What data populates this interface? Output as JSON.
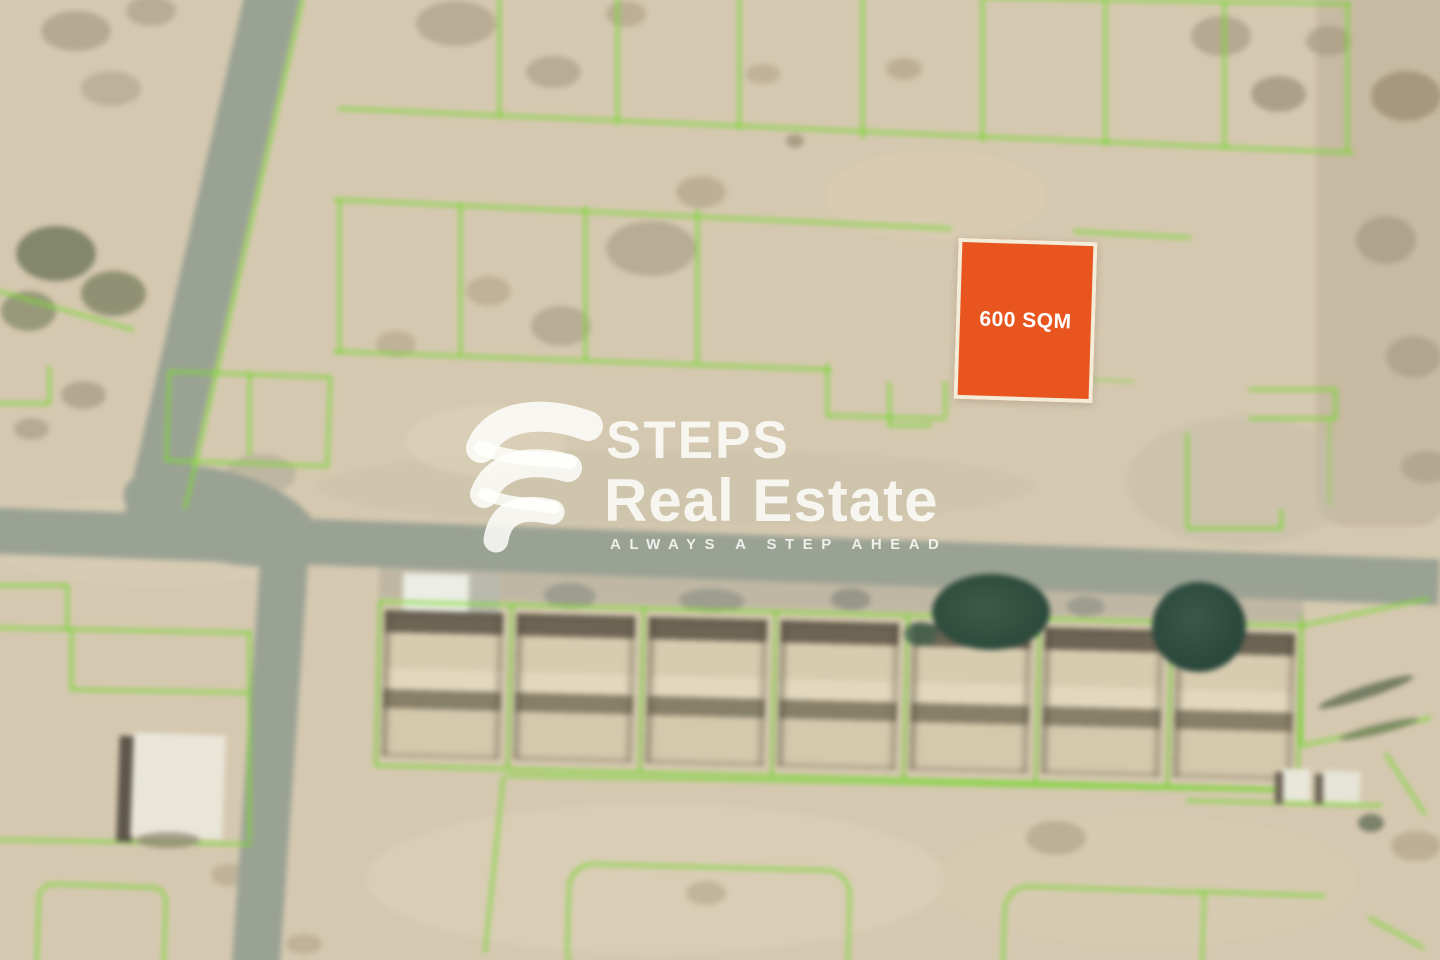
{
  "highlighted_plot": {
    "label": "600 SQM",
    "area_value": 600,
    "area_unit": "SQM",
    "fill_color": "#E8551E",
    "border_color": "#F2ECD8",
    "label_color": "#FFFFFF"
  },
  "watermark": {
    "brand_top": "STEPS",
    "brand_bottom": "Real Estate",
    "tagline": "ALWAYS A STEP AHEAD",
    "color": "#FFFFFF"
  },
  "map": {
    "plot_outline_color": "#7DD737",
    "road_color": "#9AA294",
    "sand_color": "#D5C8B0",
    "tree_color": "#2C4A3C"
  }
}
